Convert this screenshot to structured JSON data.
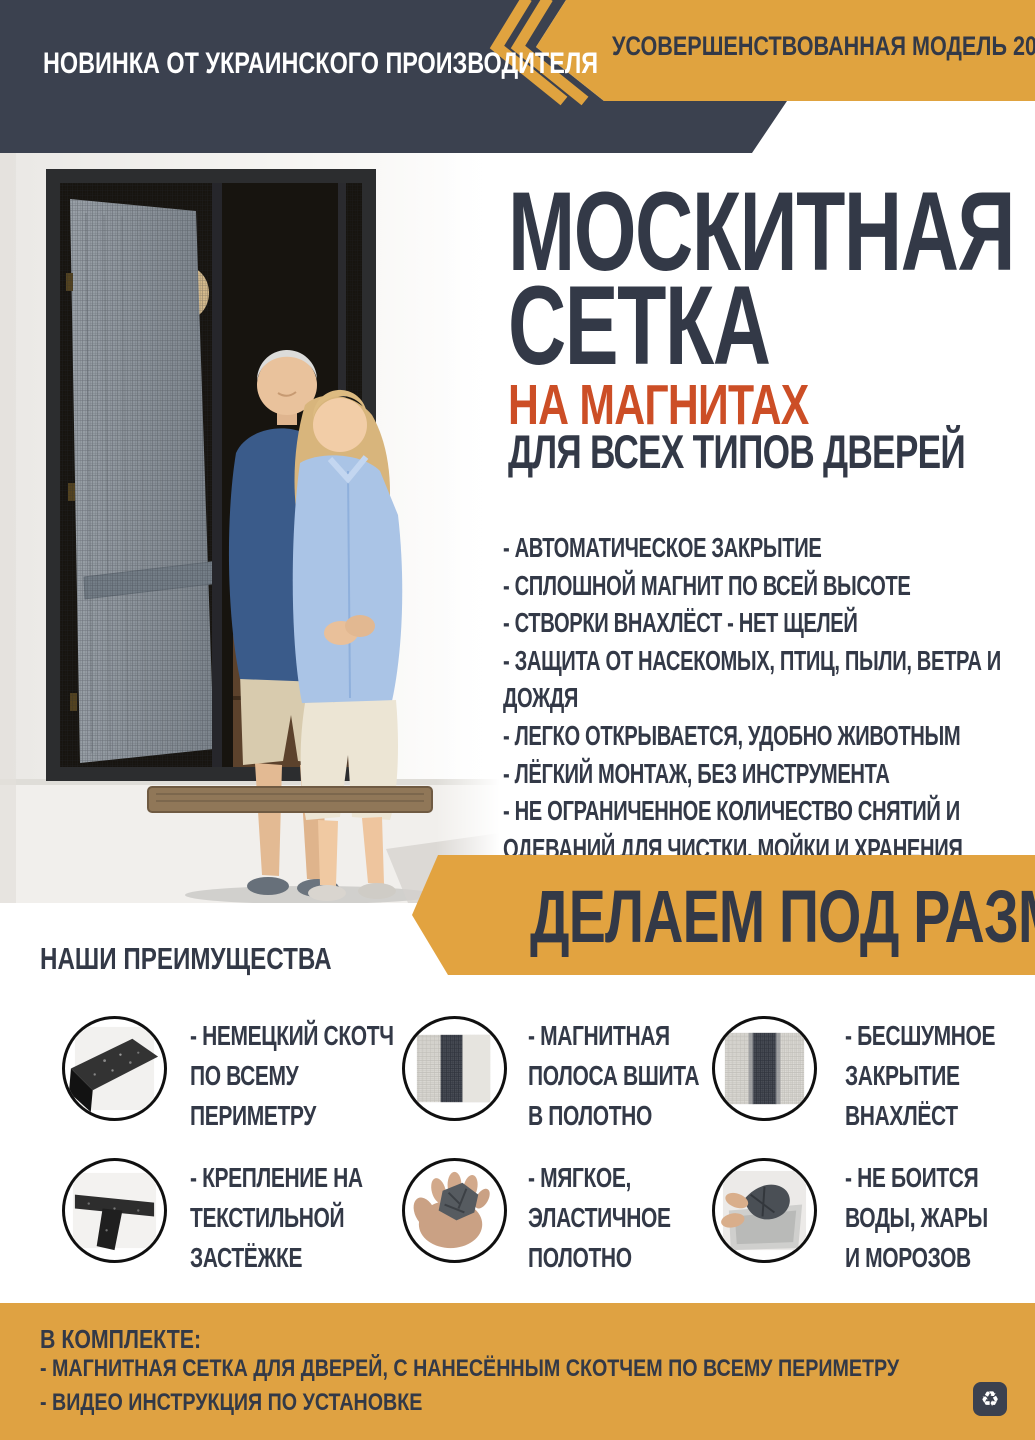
{
  "colors": {
    "navy": "#3b414f",
    "navy_text": "#333947",
    "gold": "#e0a33f",
    "accent_orange": "#cc4e26",
    "white": "#ffffff"
  },
  "header": {
    "left_badge": "НОВИНКА ОТ УКРАИНСКОГО ПРОИЗВОДИТЕЛЯ",
    "right_badge": "УСОВЕРШЕНСТВОВАННАЯ МОДЕЛЬ 2022",
    "chevron_icon": "double-chevron-left"
  },
  "hero": {
    "title_line1": "МОСКИТНАЯ",
    "title_line2": "СЕТКА",
    "subtitle_accent": "НА МАГНИТАХ",
    "subtitle": "ДЛЯ ВСЕХ ТИПОВ ДВЕРЕЙ",
    "bullets": [
      "- АВТОМАТИЧЕСКОЕ ЗАКРЫТИЕ",
      "- СПЛОШНОЙ МАГНИТ ПО ВСЕЙ ВЫСОТЕ",
      "- СТВОРКИ ВНАХЛЁСТ - НЕТ ЩЕЛЕЙ",
      "- ЗАЩИТА ОТ НАСЕКОМЫХ, ПТИЦ, ПЫЛИ, ВЕТРА И ДОЖДЯ",
      "- ЛЕГКО ОТКРЫВАЕТСЯ, УДОБНО ЖИВОТНЫМ",
      "- ЛЁГКИЙ МОНТАЖ, БЕЗ ИНСТРУМЕНТА",
      "- НЕ ОГРАНИЧЕННОЕ КОЛИЧЕСТВО СНЯТИЙ И ОДЕВАНИЙ ДЛЯ ЧИСТКИ, МОЙКИ И ХРАНЕНИЯ"
    ]
  },
  "size_banner": {
    "label": "ДЕЛАЕМ ПОД РАЗМЕР"
  },
  "advantages": {
    "heading": "НАШИ ПРЕИМУЩЕСТВА",
    "items": [
      {
        "icon": "tape",
        "lines": [
          "- НЕМЕЦКИЙ СКОТЧ",
          "ПО ВСЕМУ",
          "ПЕРИМЕТРУ"
        ]
      },
      {
        "icon": "magnet-strip-mesh",
        "lines": [
          "- МАГНИТНАЯ",
          "ПОЛОСА ВШИТА",
          "В ПОЛОТНО"
        ]
      },
      {
        "icon": "overlap-mesh",
        "lines": [
          "- БЕСШУМНОЕ",
          "ЗАКРЫТИЕ",
          "ВНАХЛЁСТ"
        ]
      },
      {
        "icon": "velcro",
        "lines": [
          "- КРЕПЛЕНИЕ НА",
          "ТЕКСТИЛЬНОЙ",
          "ЗАСТЁЖКЕ"
        ]
      },
      {
        "icon": "soft-mesh-hand",
        "lines": [
          "- МЯГКОЕ,",
          "ЭЛАСТИЧНОЕ",
          "ПОЛОТНО"
        ]
      },
      {
        "icon": "wash-resistant",
        "lines": [
          "- НЕ БОИТСЯ",
          "ВОДЫ, ЖАРЫ",
          "И МОРОЗОВ"
        ]
      }
    ]
  },
  "footer": {
    "heading": "В КОМПЛЕКТЕ:",
    "items": [
      "- МАГНИТНАЯ СЕТКА ДЛЯ ДВЕРЕЙ, С НАНЕСЁННЫМ СКОТЧЕМ ПО ВСЕМУ ПЕРИМЕТРУ",
      "- ВИДЕО ИНСТРУКЦИЯ ПО УСТАНОВКЕ"
    ],
    "recycle_icon": "♻"
  }
}
